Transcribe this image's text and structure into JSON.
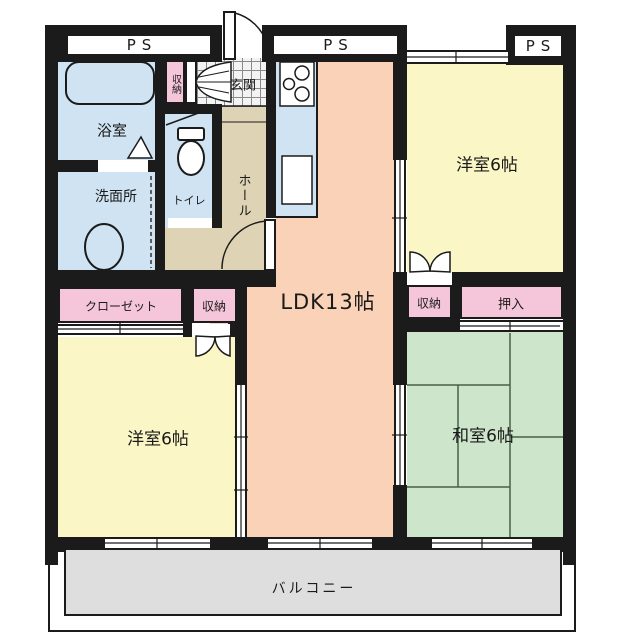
{
  "floor_plan": {
    "pipe_spaces": {
      "left": "PS",
      "center": "PS",
      "right": "PS"
    },
    "rooms": {
      "bathroom": "浴室",
      "washroom": "洗面所",
      "toilet": "トイレ",
      "entrance_storage": "収納",
      "entrance": "玄関",
      "hall": "ホール",
      "ldk": "LDK13帖",
      "western_room_top": "洋室6帖",
      "western_room_bottom": "洋室6帖",
      "japanese_room": "和室6帖",
      "closet": "クローゼット",
      "hall_storage": "収納",
      "bedroom_storage": "収納",
      "oshiire": "押入",
      "balcony": "バルコニー"
    },
    "colors": {
      "wall": "#1b1b1b",
      "wet_area_blue": "#cfe3f2",
      "ldk_peach": "#f9d2b8",
      "western_room_yellow": "#fbf6c5",
      "japanese_room_green": "#cde6cb",
      "storage_pink": "#f5c6d9",
      "hall_beige": "#ded3b4",
      "balcony_gray": "#dedede",
      "entrance_tile": "#f3f3f3"
    }
  }
}
